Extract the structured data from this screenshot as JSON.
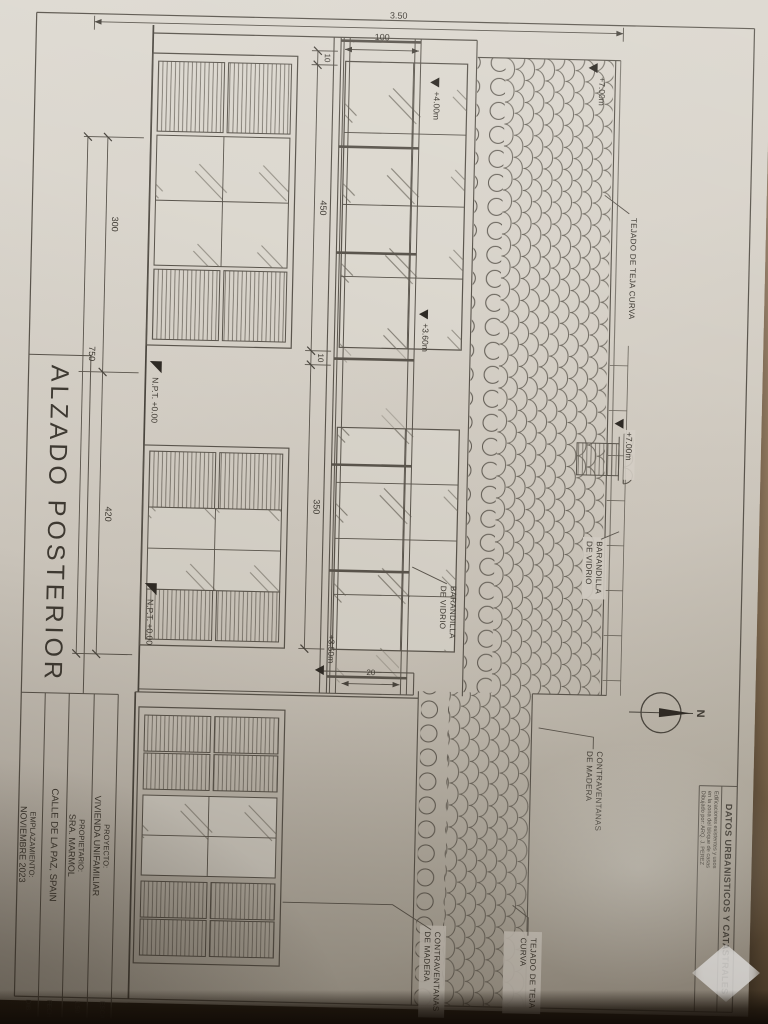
{
  "sheet_title": "ALZADO POSTERIOR",
  "title_block": {
    "rows": [
      {
        "label": "PROYECTO:",
        "value": "VIVIENDA UNIFAMILIAR"
      },
      {
        "label": "PROPIETARIO:",
        "value": "SRA. MARMOL"
      },
      {
        "label": "",
        "value": "CALLE DE LA PAZ, SPAIN"
      },
      {
        "label": "EMPLAZAMIENTO:",
        "value": "NOVIEMBRE 2023"
      }
    ],
    "edge_cells": [
      "ESCALA",
      "1:50",
      "FECHA",
      "DIB."
    ]
  },
  "datos_box": {
    "heading": "DATOS URBANISTICOS Y CATASTRALES",
    "lines": [
      "Edificaciones existentes y usos",
      "en la zona del bloque de casas",
      "Dibujado por: ARQ. J. PEREZ"
    ]
  },
  "annotations": {
    "tejado_1": "TEJADO DE TEJA CURVA",
    "tejado_2_l1": "TEJADO DE TEJA",
    "tejado_2_l2": "CURVA",
    "contraventanas_l1": "CONTRAVENTANAS",
    "contraventanas_l2": "DE MADERA",
    "barandilla_l1": "BARANDILLA",
    "barandilla_l2": "DE VIDRIO"
  },
  "levels": {
    "l400": "+4.00m",
    "l360": "+3.60m",
    "l700_roof": "+7.00m",
    "l700_chimney": "+7.00m",
    "l350": "+3.50m",
    "npt": "N.P.T. +0.00"
  },
  "dimensions": {
    "overall_height": "3.50",
    "railing": "100",
    "wall_a": "10",
    "bay_a": "450",
    "wall_b": "10",
    "bay_b": "350",
    "low_left": "300",
    "low_right": "420",
    "low_total": "750",
    "parapet": "20"
  },
  "compass": {
    "label": "N"
  }
}
